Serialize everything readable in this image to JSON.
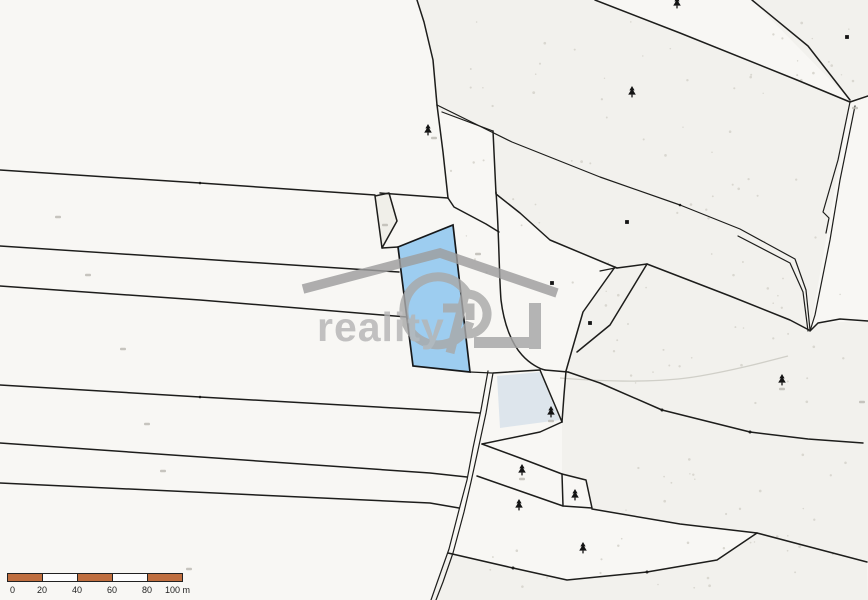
{
  "watermark": {
    "brand": "GP reality",
    "monogram_g": "G",
    "monogram_p": "P",
    "text": "reality"
  },
  "scale_bar": {
    "labels": [
      "0",
      "20",
      "40",
      "60",
      "80",
      "100 m"
    ],
    "segment_meters": 20,
    "total_meters": 100,
    "bar_color": "#bf6e3f",
    "alt_color": "#fdfdfd"
  },
  "map": {
    "highlight_parcel": {
      "fill": "#9dcdf0",
      "points": "398,247 453,225 470,372 413,366"
    },
    "colors": {
      "background": "#f8f7f4",
      "boundary": "#1d1d1b",
      "speckle_region": "#f2f1ed",
      "watermark_gray": "#a6a6a6"
    },
    "trees": [
      [
        428,
        130
      ],
      [
        677,
        3
      ],
      [
        632,
        92
      ],
      [
        782,
        380
      ],
      [
        551,
        412
      ],
      [
        522,
        470
      ],
      [
        519,
        505
      ],
      [
        575,
        495
      ],
      [
        583,
        548
      ]
    ],
    "building_dots": [
      [
        627,
        222
      ],
      [
        552,
        283
      ],
      [
        590,
        323
      ],
      [
        847,
        37
      ]
    ],
    "label_marks": [
      [
        58,
        217
      ],
      [
        88,
        275
      ],
      [
        123,
        349
      ],
      [
        147,
        424
      ],
      [
        163,
        471
      ],
      [
        189,
        569
      ],
      [
        385,
        225
      ],
      [
        478,
        254
      ],
      [
        434,
        138
      ],
      [
        551,
        421
      ],
      [
        522,
        479
      ],
      [
        782,
        389
      ],
      [
        855,
        108
      ],
      [
        862,
        402
      ]
    ],
    "speckle_regions": [
      {
        "x": 450,
        "y": 15,
        "w": 370,
        "h": 270,
        "n": 62
      },
      {
        "x": 605,
        "y": 285,
        "w": 245,
        "h": 140,
        "n": 30
      },
      {
        "x": 585,
        "y": 450,
        "w": 265,
        "h": 95,
        "n": 22
      },
      {
        "x": 475,
        "y": 542,
        "w": 370,
        "h": 48,
        "n": 18
      },
      {
        "x": 772,
        "y": 6,
        "w": 88,
        "h": 78,
        "n": 10
      }
    ]
  }
}
